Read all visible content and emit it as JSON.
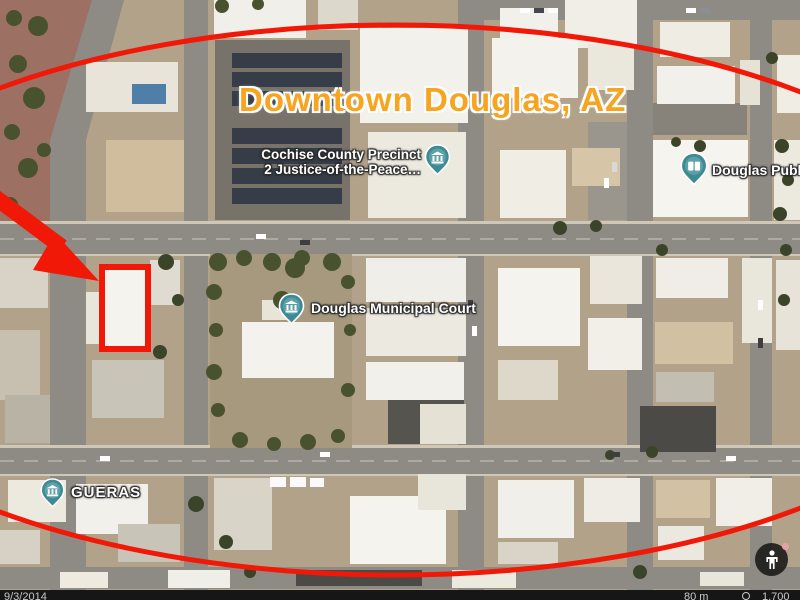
{
  "app": {
    "type": "satellite-map-view",
    "area": "Downtown Douglas, AZ"
  },
  "title": {
    "text": "Downtown Douglas, AZ"
  },
  "map_labels": {
    "cochise": {
      "line1": "Cochise County Precinct",
      "line2": "2 Justice-of-the-Peace…",
      "icon": "courthouse-pin-icon"
    },
    "municipal_court": {
      "text": "Douglas Municipal Court",
      "icon": "courthouse-pin-icon"
    },
    "public_library": {
      "text": "Douglas Public",
      "icon": "library-pin-icon"
    },
    "gueras": {
      "text": "GUERAS",
      "icon": "courthouse-pin-icon"
    }
  },
  "annotations": {
    "color": "#F21807",
    "items": [
      "ellipse-outline",
      "arrow-to-building",
      "building-highlight-rectangle"
    ]
  },
  "status_bar": {
    "imagery_date": "9/3/2014",
    "scale": "80 m",
    "eye_altitude": "1,700"
  },
  "controls": {
    "pegman": "pegman-icon"
  },
  "colors": {
    "title_orange": "#F7A41F",
    "annotation_red": "#F21807",
    "label_pin_teal": "#3D8A94",
    "status_bar_bg": "#161616"
  }
}
